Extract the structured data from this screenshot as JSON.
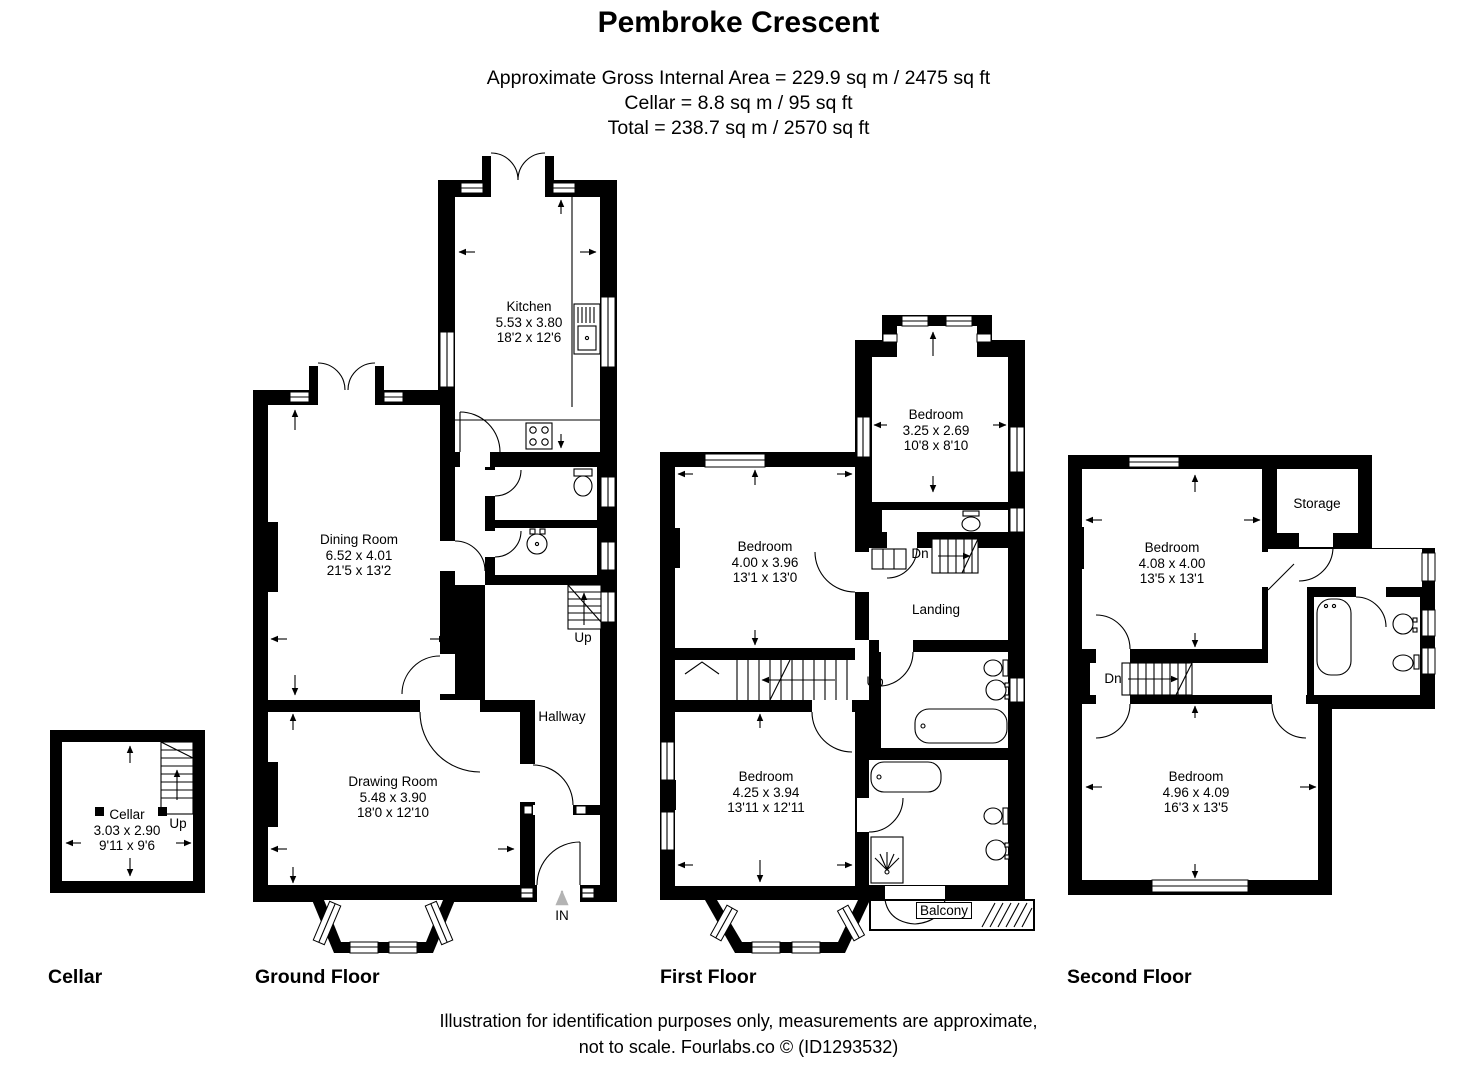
{
  "header": {
    "title": "Pembroke Crescent",
    "area_lines": [
      "Approximate Gross Internal Area = 229.9 sq m / 2475 sq ft",
      "Cellar = 8.8 sq m / 95 sq ft",
      "Total = 238.7 sq m / 2570 sq ft"
    ]
  },
  "rooms": {
    "cellar": {
      "name": "Cellar",
      "metric": "3.03 x 2.90",
      "imperial": "9'11 x 9'6"
    },
    "kitchen": {
      "name": "Kitchen",
      "metric": "5.53 x 3.80",
      "imperial": "18'2 x 12'6"
    },
    "dining_room": {
      "name": "Dining Room",
      "metric": "6.52 x 4.01",
      "imperial": "21'5 x 13'2"
    },
    "drawing_room": {
      "name": "Drawing Room",
      "metric": "5.48 x 3.90",
      "imperial": "18'0 x 12'10"
    },
    "hallway": {
      "name": "Hallway"
    },
    "ff_bedroom_top": {
      "name": "Bedroom",
      "metric": "3.25 x 2.69",
      "imperial": "10'8 x 8'10"
    },
    "ff_bedroom_mid": {
      "name": "Bedroom",
      "metric": "4.00 x 3.96",
      "imperial": "13'1 x 13'0"
    },
    "ff_bedroom_bottom": {
      "name": "Bedroom",
      "metric": "4.25 x 3.94",
      "imperial": "13'11 x 12'11"
    },
    "landing": {
      "name": "Landing"
    },
    "balcony": {
      "name": "Balcony"
    },
    "storage": {
      "name": "Storage"
    },
    "sf_bedroom_top": {
      "name": "Bedroom",
      "metric": "4.08 x 4.00",
      "imperial": "13'5 x 13'1"
    },
    "sf_bedroom_bottom": {
      "name": "Bedroom",
      "metric": "4.96 x 4.09",
      "imperial": "16'3 x 13'5"
    }
  },
  "annotations": {
    "up": "Up",
    "down": "Dn",
    "entrance": "IN"
  },
  "floor_labels": {
    "cellar": "Cellar",
    "ground": "Ground Floor",
    "first": "First Floor",
    "second": "Second Floor"
  },
  "footer": {
    "lines": [
      "Illustration for identification purposes only, measurements are approximate,",
      "not to scale. Fourlabs.co © (ID1293532)"
    ]
  },
  "colors": {
    "wall": "#000000",
    "background": "#ffffff",
    "entrance_arrow": "#b3b3b3"
  }
}
